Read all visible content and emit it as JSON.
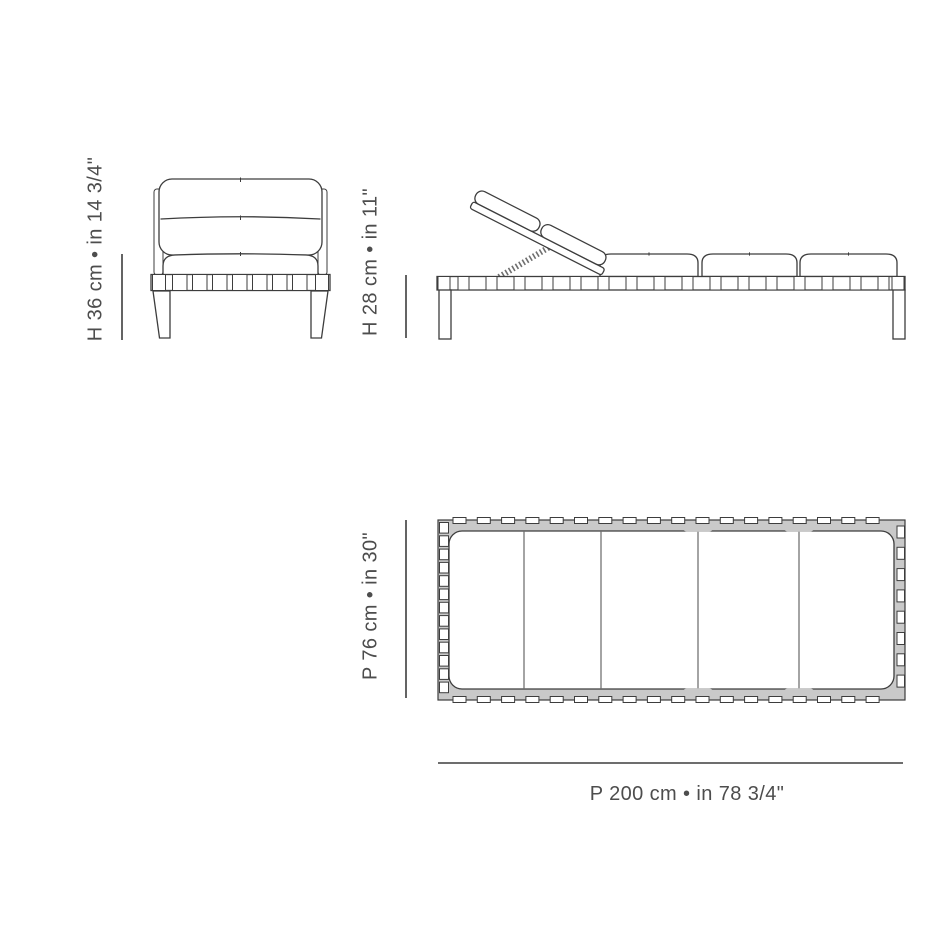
{
  "labels": {
    "front_height": "H 36 cm • in 14 3/4\"",
    "side_height": "H 28 cm • in 11\"",
    "top_depth": "P 76 cm • in 30\"",
    "top_length": "P 200 cm • in 78 3/4\""
  },
  "colors": {
    "line": "#3d3d3d",
    "text": "#4d4d4d",
    "fill": "#ffffff",
    "webbing": "#c9c9c9",
    "background": "#ffffff"
  }
}
